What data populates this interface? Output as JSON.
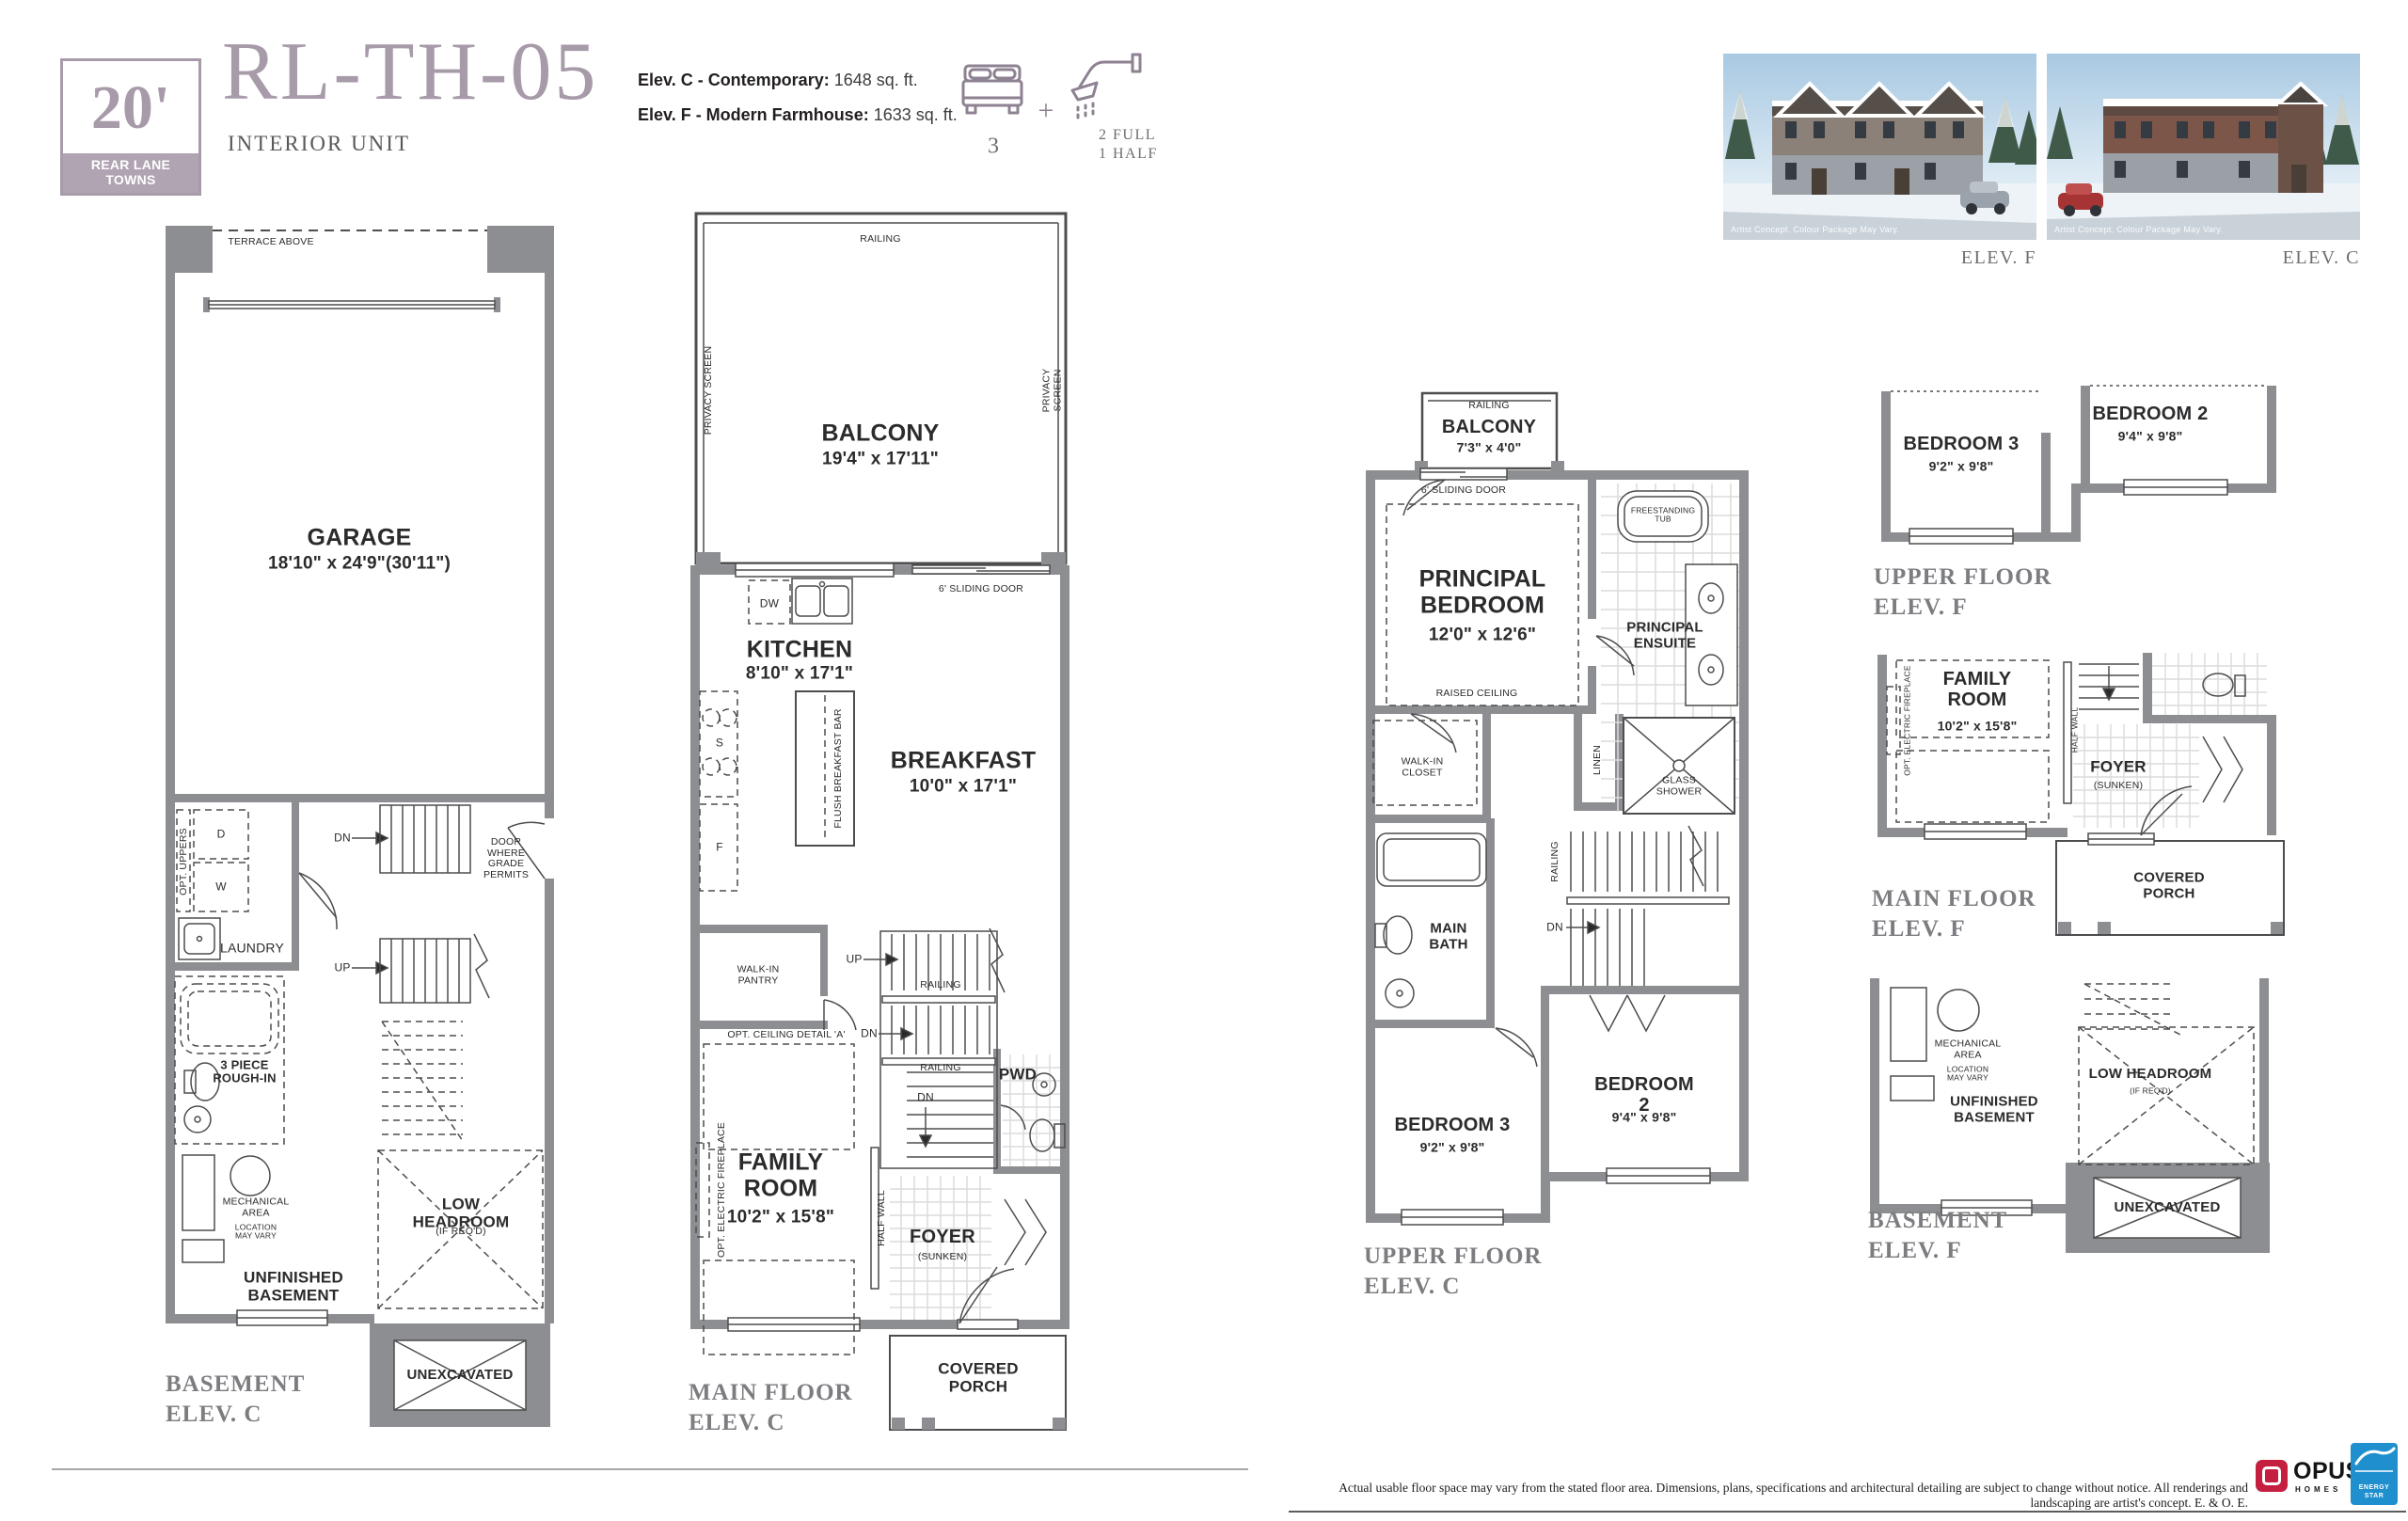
{
  "colors": {
    "brand": "#a79aa9",
    "badge_band": "#b0a3b2",
    "wall_gray": "#8d8e91",
    "ink": "#2b2b2d",
    "caption_gray": "#7c7d80",
    "opus_red": "#c41f3e",
    "energy_blue": "#1f8fce"
  },
  "header": {
    "badge_size": "20'",
    "badge_label": "REAR LANE\nTOWNS",
    "model": "RL-TH-05",
    "unit_type": "INTERIOR UNIT",
    "elev_c_label": "Elev. C - Contemporary:",
    "elev_c_value": "1648 sq. ft.",
    "elev_f_label": "Elev. F - Modern Farmhouse:",
    "elev_f_value": "1633 sq. ft.",
    "beds": "3",
    "plus": "+",
    "baths": "2 FULL\n1 HALF"
  },
  "renders": {
    "watermark": "Artist Concept. Colour Package May Vary.",
    "elev_f_caption": "ELEV. F",
    "elev_c_caption": "ELEV. C"
  },
  "plan_basement_c": {
    "terrace": "TERRACE ABOVE",
    "garage": "GARAGE",
    "garage_dim": "18'10\" x 24'9\"(30'11\")",
    "opt_uppers": "OPT. UPPERS",
    "d": "D",
    "w": "W",
    "laundry": "LAUNDRY",
    "door_grade": "DOOR\nWHERE\nGRADE\nPERMITS",
    "dn": "DN",
    "up": "UP",
    "rough_in": "3 PIECE\nROUGH-IN",
    "mech": "MECHANICAL\nAREA",
    "mech_sub": "LOCATION\nMAY VARY",
    "unfinished": "UNFINISHED\nBASEMENT",
    "low_headroom": "LOW HEADROOM",
    "low_headroom_sub": "(IF REQ'D)",
    "unexcavated": "UNEXCAVATED",
    "caption": "BASEMENT\nELEV. C"
  },
  "plan_main_c": {
    "railing": "RAILING",
    "balcony": "BALCONY",
    "balcony_dim": "19'4\" x 17'11\"",
    "privacy": "PRIVACY SCREEN",
    "sliding": "6' SLIDING DOOR",
    "dw": "DW",
    "kitchen": "KITCHEN",
    "kitchen_dim": "8'10\" x 17'1\"",
    "s": "S",
    "f": "F",
    "island": "FLUSH BREAKFAST BAR",
    "breakfast": "BREAKFAST",
    "breakfast_dim": "10'0\" x 17'1\"",
    "pantry": "WALK-IN\nPANTRY",
    "up": "UP",
    "dn": "DN",
    "ceiling": "OPT. CEILING DETAIL 'A'",
    "fireplace": "OPT. ELECTRIC FIREPLACE",
    "family": "FAMILY\nROOM",
    "family_dim": "10'2\" x 15'8\"",
    "half_wall": "HALF WALL",
    "pwd": "PWD",
    "foyer": "FOYER",
    "foyer_sub": "(SUNKEN)",
    "porch": "COVERED\nPORCH",
    "caption": "MAIN FLOOR\nELEV. C"
  },
  "plan_upper_c": {
    "railing": "RAILING",
    "balcony": "BALCONY",
    "balcony_dim": "7'3\" x 4'0\"",
    "sliding": "6' SLIDING DOOR",
    "principal": "PRINCIPAL\nBEDROOM",
    "principal_dim": "12'0\" x 12'6\"",
    "raised": "RAISED CEILING",
    "tub": "FREESTANDING\nTUB",
    "ensuite": "PRINCIPAL\nENSUITE",
    "wic": "WALK-IN\nCLOSET",
    "linen": "LINEN",
    "shower": "GLASS\nSHOWER",
    "main_bath": "MAIN\nBATH",
    "dn": "DN",
    "bed3": "BEDROOM 3",
    "bed3_dim": "9'2\" x 9'8\"",
    "bed2": "BEDROOM 2",
    "bed2_dim": "9'4\" x 9'8\"",
    "caption": "UPPER FLOOR\nELEV. C"
  },
  "plan_upper_f": {
    "bed3": "BEDROOM 3",
    "bed3_dim": "9'2\" x 9'8\"",
    "bed2": "BEDROOM 2",
    "bed2_dim": "9'4\" x 9'8\"",
    "caption": "UPPER FLOOR\nELEV. F"
  },
  "plan_main_f": {
    "family": "FAMILY\nROOM",
    "family_dim": "10'2\" x 15'8\"",
    "fireplace": "OPT. ELECTRIC FIREPLACE",
    "half_wall": "HALF WALL",
    "foyer": "FOYER",
    "foyer_sub": "(SUNKEN)",
    "porch": "COVERED\nPORCH",
    "caption": "MAIN FLOOR\nELEV. F"
  },
  "plan_basement_f": {
    "mech": "MECHANICAL\nAREA",
    "mech_sub": "LOCATION\nMAY VARY",
    "unfinished": "UNFINISHED\nBASEMENT",
    "low_headroom": "LOW HEADROOM",
    "low_headroom_sub": "(IF REQ'D)",
    "unexcavated": "UNEXCAVATED",
    "caption": "BASEMENT\nELEV. F"
  },
  "footer": {
    "disclaimer": "Actual usable floor space may vary from the stated floor area. Dimensions, plans, specifications and architectural detailing are subject to change without notice. All renderings and landscaping are artist's concept. E. & O. E.",
    "opus": "OPUS",
    "opus_sub": "HOMES",
    "energy_star": "ENERGY\nSTAR"
  }
}
